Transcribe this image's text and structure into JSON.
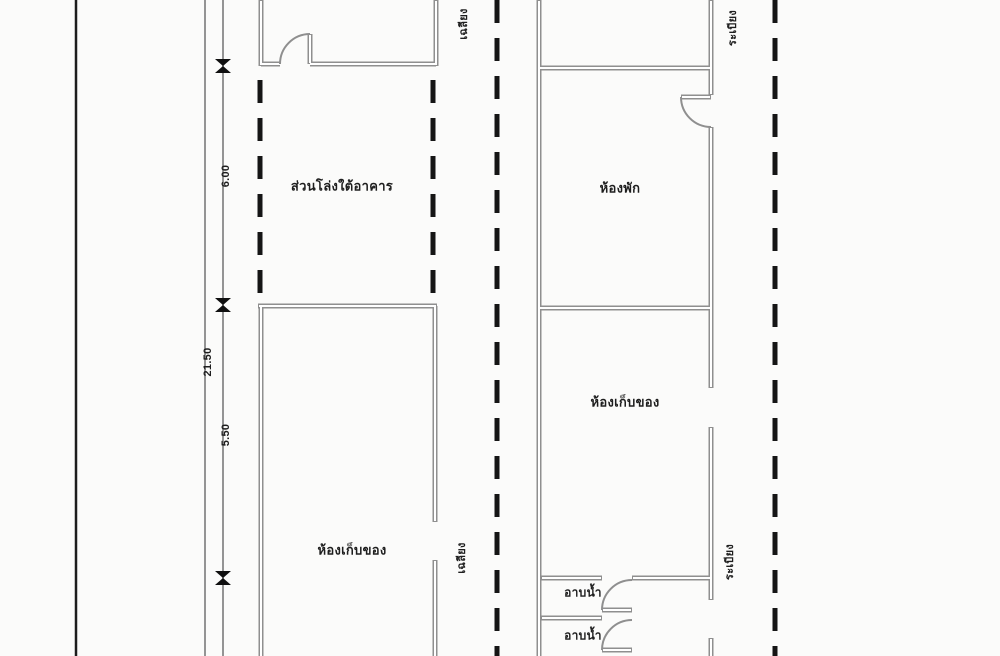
{
  "colors": {
    "paper": "#fbfbfa",
    "wall": "#8f8f8f",
    "boundary_dash": "#151515",
    "dimension_line": "#7a7a7a",
    "text": "#1e1e1e"
  },
  "rooms": {
    "open_under_building": "ส่วนโล่งใต้อาคาร",
    "living_room": "ห้องพัก",
    "storage_right": "ห้องเก็บของ",
    "storage_left": "ห้องเก็บของ",
    "bath_upper": "อาบน้ำ",
    "bath_lower": "อาบน้ำ"
  },
  "side_annotations": {
    "porch_top": "เฉลียง",
    "balcony_top": "ระเบียง",
    "porch_mid": "เฉลียง",
    "balcony_mid": "ระเบียง"
  },
  "dimensions": {
    "overall": "21.50",
    "upper_segment": "6.00",
    "lower_segment": "5.50"
  }
}
